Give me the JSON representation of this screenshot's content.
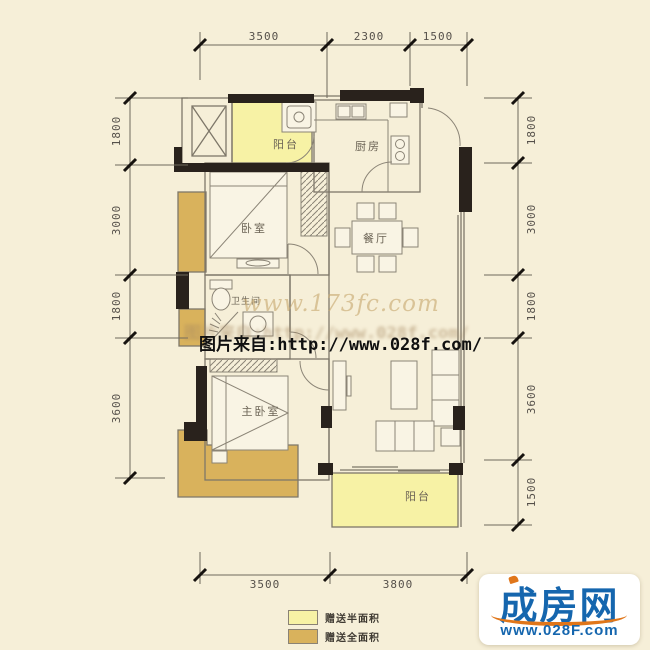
{
  "dimensions": {
    "top": [
      "3500",
      "2300",
      "1500"
    ],
    "bottom": [
      "3500",
      "3800"
    ],
    "left": [
      "1800",
      "3000",
      "1800",
      "3600"
    ],
    "right": [
      "1800",
      "3000",
      "1800",
      "3600",
      "1500"
    ]
  },
  "rooms": {
    "balcony_top": "阳台",
    "kitchen": "厨房",
    "bedroom": "卧室",
    "dining": "餐厅",
    "bathroom": "卫生间",
    "master_bedroom": "主卧室",
    "balcony_bottom": "阳台"
  },
  "watermarks": {
    "site": "www.173fc.com",
    "source_faint": "图片来自:http://www.028f.com/",
    "source": "图片来自:http://www.028f.com/"
  },
  "legend": {
    "half_area": {
      "label": "赠送半面积",
      "color": "#f7f1a3"
    },
    "full_area": {
      "label": "赠送全面积",
      "color": "#d9b25c"
    }
  },
  "logo": {
    "name": "成房网",
    "url": "www.028F.com",
    "blue": "#1566ae",
    "orange": "#e0761a"
  },
  "colors": {
    "background": "#f6efd8",
    "gift_half": "#f7f2a5",
    "gift_full": "#d9b25c",
    "wall": "#29221c",
    "line": "#7e7769"
  }
}
